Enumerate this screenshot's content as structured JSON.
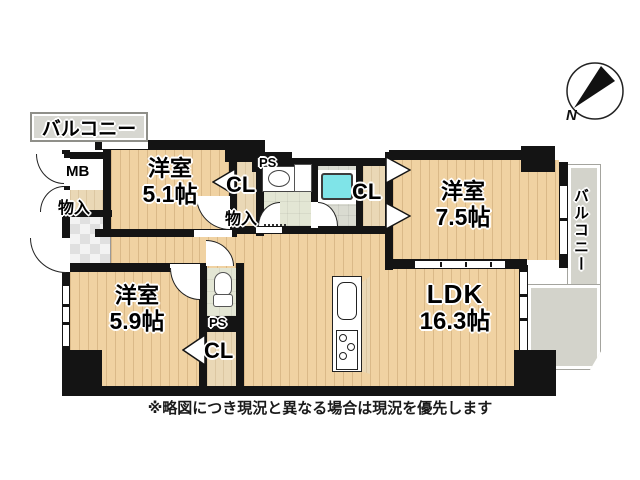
{
  "plan": {
    "note": "※略図につき現況と異なる場合は現況を優先します",
    "compass": {
      "north_label": "N"
    },
    "balconies": {
      "top": "バルコニー",
      "right": "バルコニー"
    },
    "rooms": [
      {
        "name": "洋室",
        "size": "5.1帖"
      },
      {
        "name": "洋室",
        "size": "7.5帖"
      },
      {
        "name": "洋室",
        "size": "5.9帖"
      },
      {
        "name": "LDK",
        "size": "16.3帖"
      }
    ],
    "labels": {
      "meter_box": "MB",
      "storage_left": "物入",
      "hall_closet": "CL",
      "hall_storage": "物入",
      "pipe_space_top": "PS",
      "bedroom2_closet": "CL",
      "pipe_space_mid": "PS",
      "toilet_closet": "CL"
    },
    "colors": {
      "wall": "#141414",
      "wood_floor": "#f0d2a2",
      "closet_floor": "#ead8b6",
      "wet_area_floor": "#e3e6d4",
      "bath_floor": "#dadbd1",
      "balcony": "#d3d3cb",
      "bathtub": "#7fe4e8"
    }
  }
}
